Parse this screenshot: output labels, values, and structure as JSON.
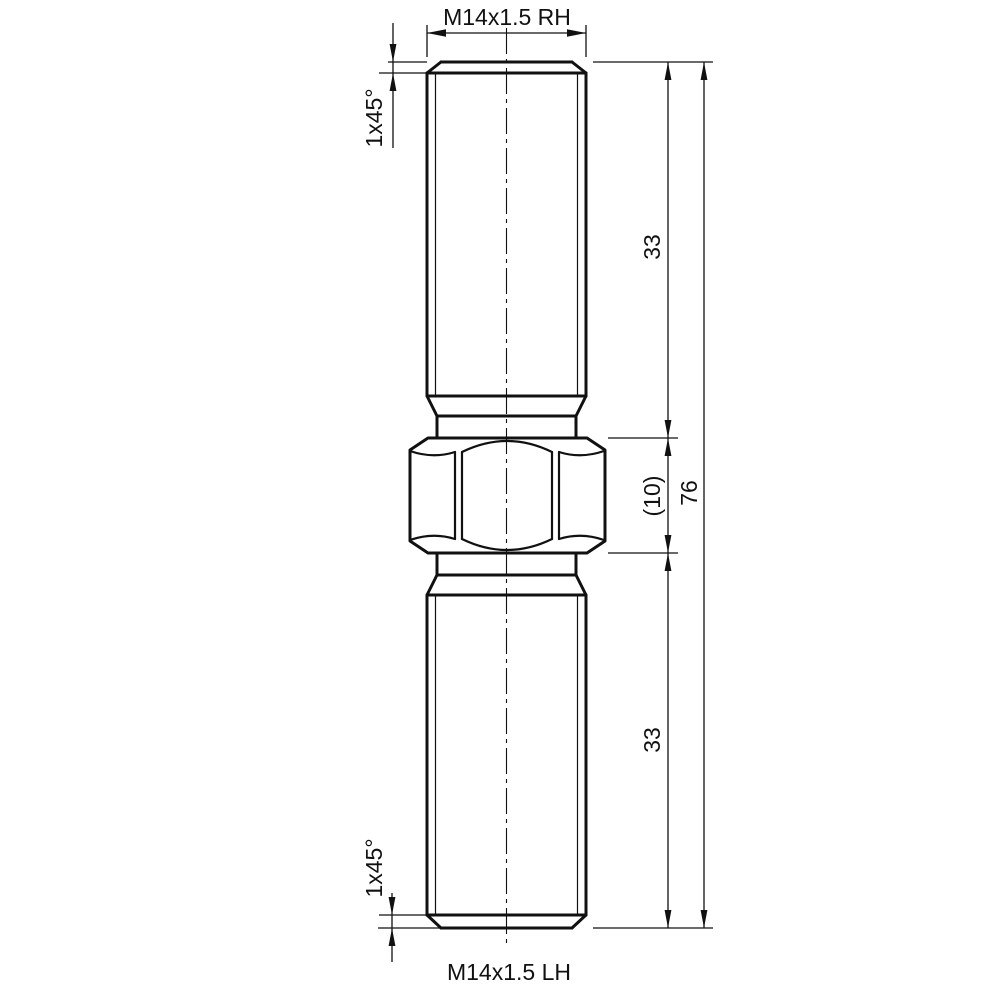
{
  "drawing": {
    "labels": {
      "thread_top": "M14x1.5 RH",
      "thread_bottom": "M14x1.5 LH",
      "chamfer_top": "1x45°",
      "chamfer_bottom": "1x45°",
      "length_top": "33",
      "hex_width": "(10)",
      "length_bottom": "33",
      "length_overall": "76"
    },
    "part": {
      "type": "double-ended threaded stud with center hex",
      "thread_spec": "M14x1.5",
      "top_thread_hand": "RH",
      "bottom_thread_hand": "LH",
      "top_thread_length_mm": 33,
      "hex_length_mm": 10,
      "bottom_thread_length_mm": 33,
      "overall_length_mm": 76,
      "chamfer": "1x45°"
    },
    "colors": {
      "line": "#111111",
      "background": "#ffffff"
    }
  }
}
